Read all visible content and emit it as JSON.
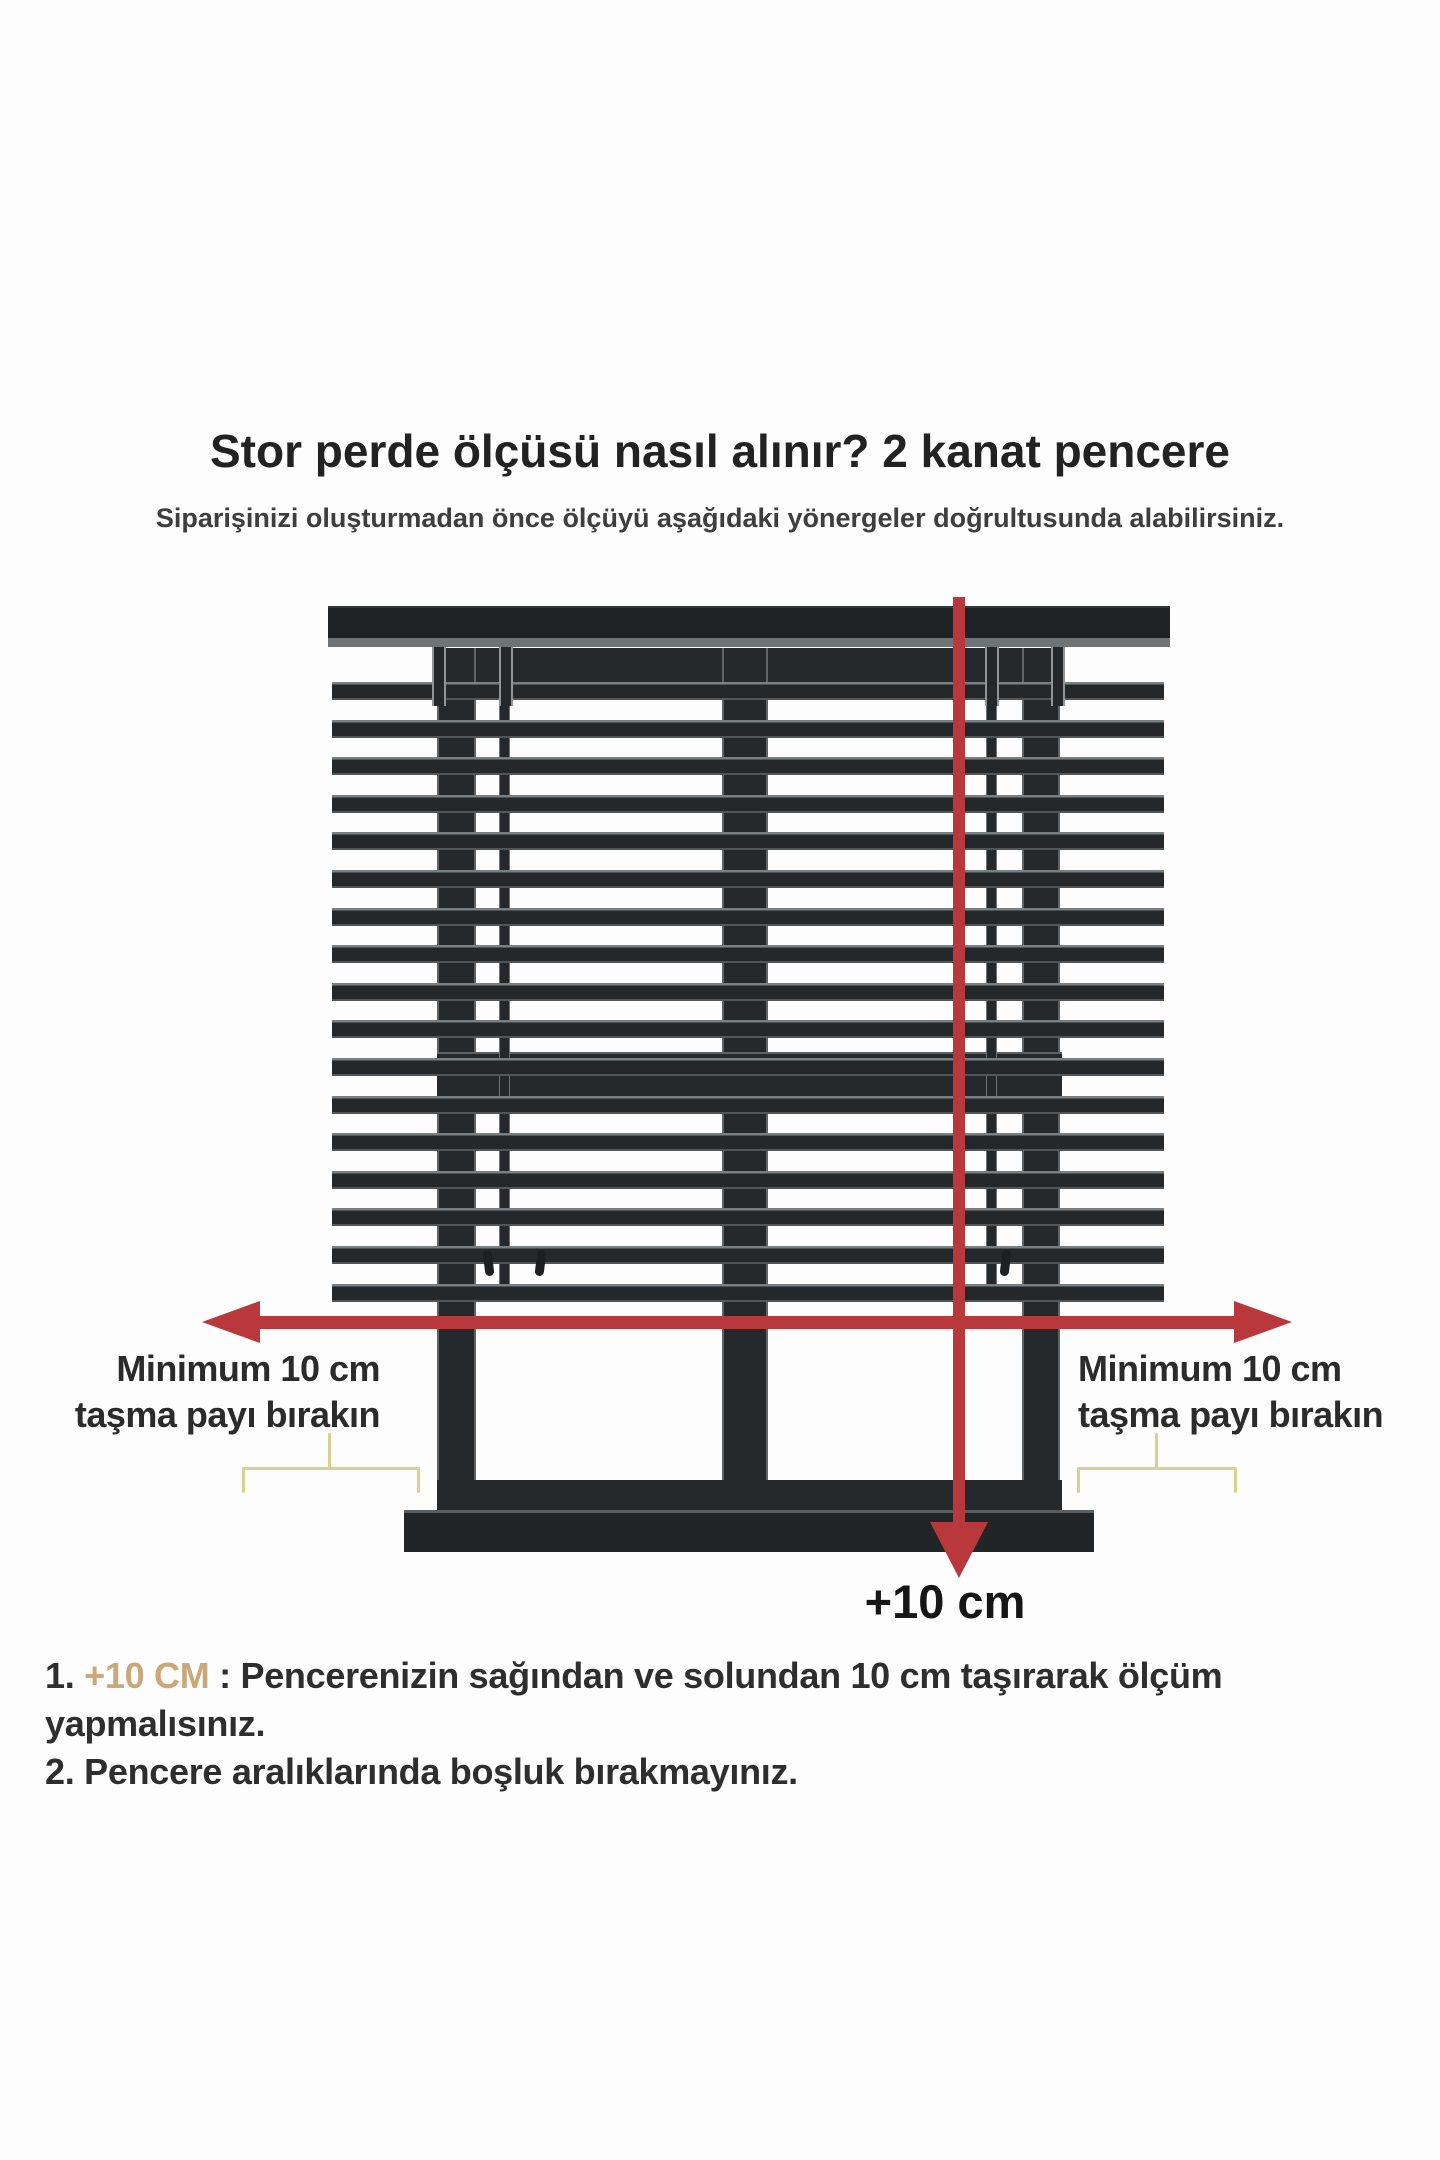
{
  "header": {
    "title": "Stor perde ölçüsü nasıl alınır? 2 kanat pencere",
    "subtitle": "Siparişinizi oluşturmadan önce ölçüyü aşağıdaki yönergeler doğrultusunda alabilirsiniz."
  },
  "diagram": {
    "left_label": {
      "line1": "Minimum 10 cm",
      "line2": "taşma payı bırakın"
    },
    "right_label": {
      "line1": "Minimum 10 cm",
      "line2": "taşma payı bırakın"
    },
    "bottom_arrow_label": "+10 cm",
    "colors": {
      "arrow_red": "#b9383b",
      "bracket_yellow": "#d9d18f",
      "frame_dark": "#26292b",
      "highlight_tan": "#c9a87c"
    },
    "blind": {
      "slat_count": 17,
      "slat_start_y": 682,
      "slat_step_y": 37.6
    }
  },
  "notes": [
    {
      "prefix": "1. ",
      "highlight": "+10 CM",
      "rest": " : Pencerenizin sağından ve solundan 10 cm taşırarak ölçüm yapmalısınız."
    },
    {
      "prefix": "2. ",
      "highlight": "",
      "rest": "Pencere aralıklarında boşluk bırakmayınız."
    }
  ]
}
